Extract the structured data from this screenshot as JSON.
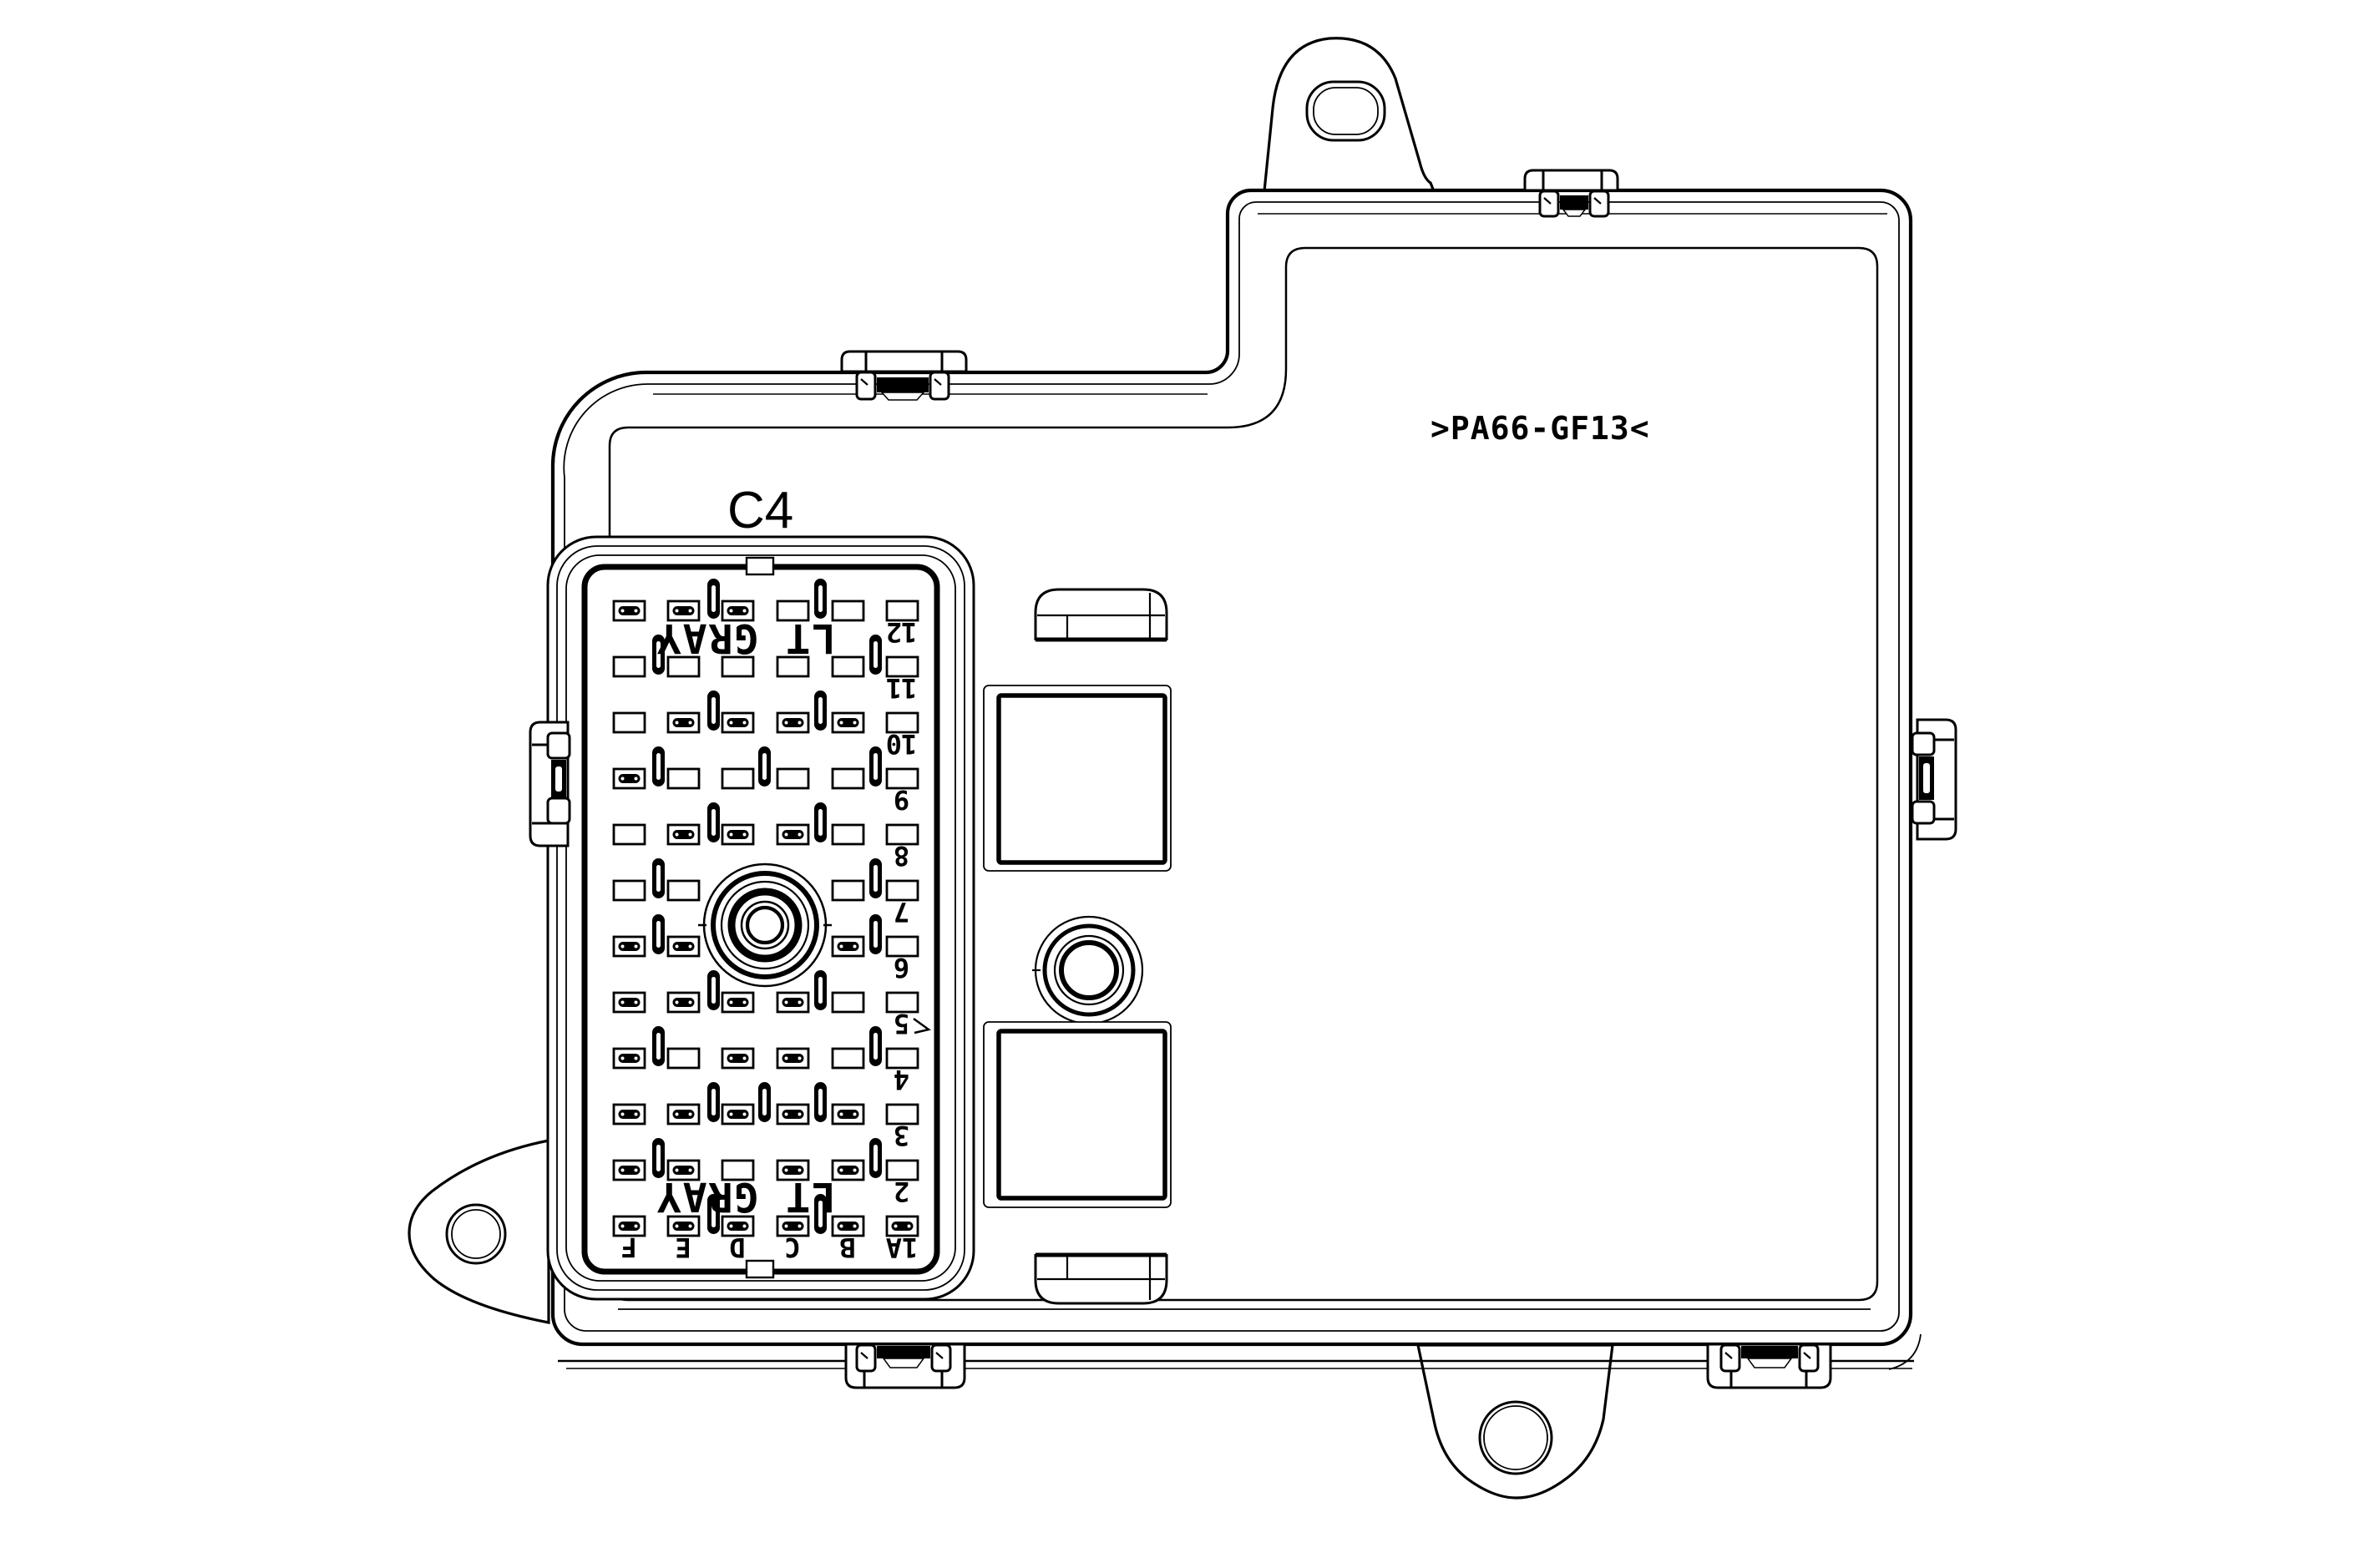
{
  "page": {
    "background": "#ffffff",
    "line_color": "#000000"
  },
  "diagram": {
    "part_label": "C4",
    "material_marking": ">PA66-GF13<",
    "connector": {
      "color_label": "LT GRAY",
      "row_numbers": [
        "12",
        "11",
        "10",
        "9",
        "8",
        "7",
        "6",
        "5",
        "4",
        "3",
        "2"
      ],
      "corner_label": "1A",
      "col_letters": [
        "F",
        "E",
        "D",
        "C",
        "B"
      ]
    }
  }
}
